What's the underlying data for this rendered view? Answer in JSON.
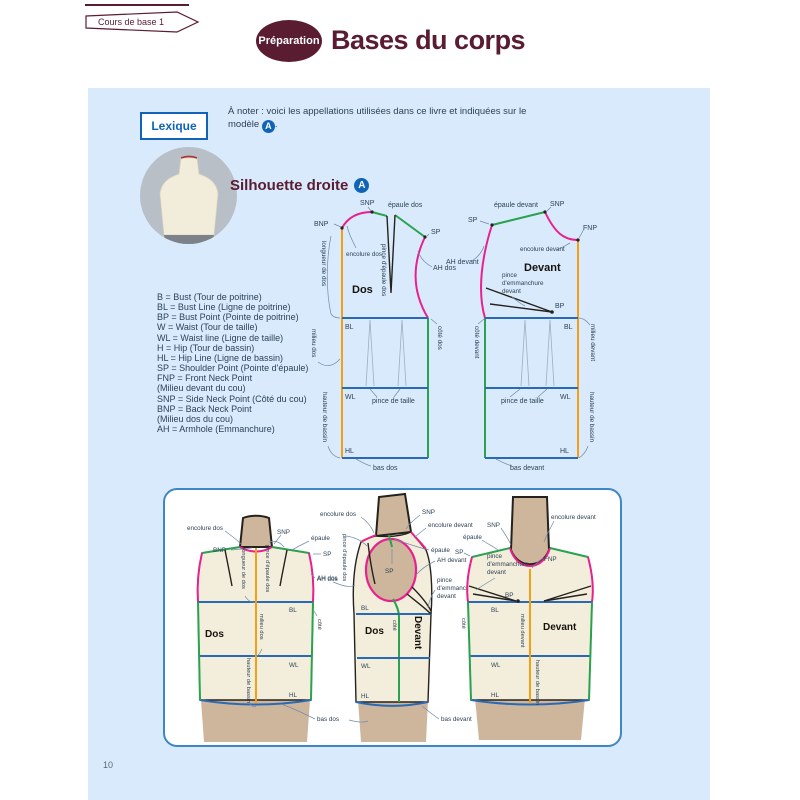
{
  "page_number": "10",
  "header": {
    "breadcrumb": "Cours de base 1",
    "badge": "Préparation",
    "title": "Bases du corps"
  },
  "lexique": {
    "box_label": "Lexique",
    "note_prefix": "À noter : voici les appellations utilisées dans ce livre et indiquées sur le modèle",
    "model_badge": "A",
    "note_suffix": "."
  },
  "section": {
    "title": "Silhouette droite",
    "badge": "A"
  },
  "abbreviations": [
    "B = Bust (Tour de poitrine)",
    "BL = Bust Line (Ligne de poitrine)",
    "BP = Bust Point (Pointe de poitrine)",
    "W = Waist (Tour de taille)",
    "WL = Waist line (Ligne de taille)",
    "H = Hip (Tour de bassin)",
    "HL = Hip Line (Ligne de bassin)",
    "SP = Shoulder Point (Pointe d'épaule)",
    "FNP = Front Neck Point",
    "(Milieu devant du cou)",
    "SNP = Side Neck Point (Côté du cou)",
    "BNP = Back Neck Point",
    "(Milieu dos du cou)",
    "AH = Armhole (Emmanchure)"
  ],
  "labels": {
    "bnp": "BNP",
    "snp": "SNP",
    "sp": "SP",
    "fnp": "FNP",
    "bp": "BP",
    "bl": "BL",
    "wl": "WL",
    "hl": "HL",
    "dos": "Dos",
    "devant": "Devant",
    "epaule": "épaule",
    "epaule_dos": "épaule dos",
    "epaule_devant": "épaule devant",
    "encolure_dos": "encolure dos",
    "encolure_devant": "encolure devant",
    "pince": "pince",
    "demmanchure": "d'emmanchure",
    "devant_min": "devant",
    "pince_epaule_dos": "pince d'épaule dos",
    "pince_de_taille": "pince de taille",
    "ah_dos": "AH dos",
    "ah_devant": "AH devant",
    "longueur_de_dos": "longueur de dos",
    "milieu_dos": "milieu dos",
    "milieu_devant": "milieu devant",
    "cote": "côté",
    "cote_dos": "côté dos",
    "cote_devant": "côté devant",
    "hauteur_de_bassin": "hauteur de bassin",
    "bas_dos": "bas dos",
    "bas_devant": "bas devant"
  },
  "colors": {
    "accent_maroon": "#5a1c30",
    "panel_blue": "#d8eafc",
    "badge_blue": "#1064b8",
    "seam_pink": "#e9218f",
    "seam_green": "#2aa24f",
    "line_blue": "#2a6ab5",
    "line_orange": "#f4a013",
    "text_dark": "#2e4257"
  }
}
